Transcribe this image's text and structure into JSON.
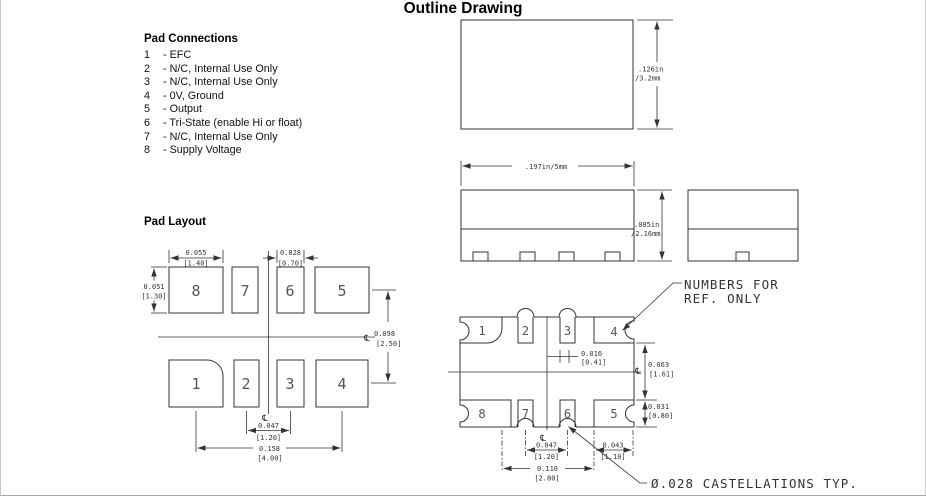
{
  "title": "Outline Drawing",
  "pad_connections": {
    "heading": "Pad Connections",
    "items": [
      {
        "num": "1",
        "desc": "- EFC"
      },
      {
        "num": "2",
        "desc": "- N/C, Internal Use Only"
      },
      {
        "num": "3",
        "desc": "- N/C, Internal Use Only"
      },
      {
        "num": "4",
        "desc": "- 0V, Ground"
      },
      {
        "num": "5",
        "desc": "- Output"
      },
      {
        "num": "6",
        "desc": "- Tri-State (enable Hi or float)"
      },
      {
        "num": "7",
        "desc": "- N/C, Internal Use Only"
      },
      {
        "num": "8",
        "desc": "- Supply Voltage"
      }
    ]
  },
  "pad_layout": {
    "heading": "Pad Layout",
    "centerline_symbol": "℄",
    "pads": {
      "p1": "1",
      "p2": "2",
      "p3": "3",
      "p4": "4",
      "p5": "5",
      "p6": "6",
      "p7": "7",
      "p8": "8"
    },
    "dims": {
      "pad_width_in": "0.055",
      "pad_width_mm": "[1.40]",
      "small_pad_width_in": "0.028",
      "small_pad_width_mm": "[0.70]",
      "pad_height_in": "0.051",
      "pad_height_mm": "[1.30]",
      "row_pitch_in": "0.098",
      "row_pitch_mm": "[2.50]",
      "inner_pad_pitch_in": "0.047",
      "inner_pad_pitch_mm": "[1.20]",
      "outer_pad_span_in": "0.158",
      "outer_pad_span_mm": "[4.00]"
    }
  },
  "outline_views": {
    "top_view": {
      "height_in": ".126in",
      "height_mm": "/3.2mm"
    },
    "side_view": {
      "width": ".197in/5mm",
      "height_in": ".085in",
      "height_mm": "/2.16mm"
    },
    "bottom_view": {
      "centerline_symbol": "℄",
      "pads": {
        "p1": "1",
        "p2": "2",
        "p3": "3",
        "p4": "4",
        "p5": "5",
        "p6": "6",
        "p7": "7",
        "p8": "8"
      },
      "dims": {
        "cast_width_in": "0.016",
        "cast_width_mm": "[0.41]",
        "center_to_edge_in": "0.063",
        "center_to_edge_mm": "[1.61]",
        "pad_depth_in": "0.031",
        "pad_depth_mm": "[0.80]",
        "pad_pitch_in": "0.047",
        "pad_pitch_mm": "[1.20]",
        "edge_pad_in": "0.043",
        "edge_pad_mm": "[1.10]",
        "span_in": "0.110",
        "span_mm": "[2.80]"
      },
      "ref_note_line1": "NUMBERS FOR",
      "ref_note_line2": "REF. ONLY",
      "castellation_note": "Ø.028 CASTELLATIONS TYP."
    }
  }
}
